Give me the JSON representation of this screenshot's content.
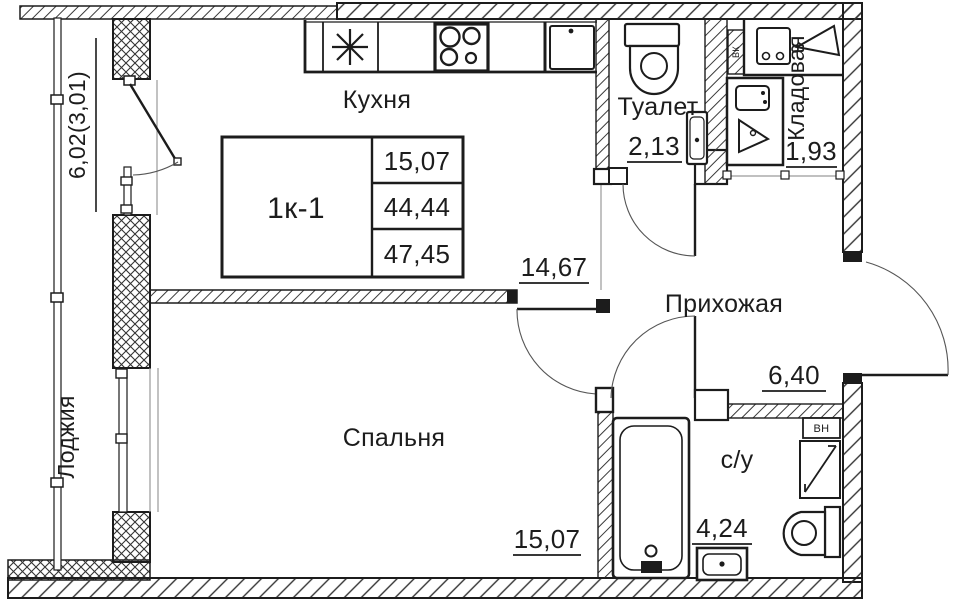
{
  "plan": {
    "rooms": {
      "kitchen": {
        "name": "Кухня",
        "area": "14,67"
      },
      "bedroom": {
        "name": "Спальня",
        "area": "15,07"
      },
      "hallway": {
        "name": "Прихожая",
        "area": "6,40"
      },
      "toilet": {
        "name": "Туалет",
        "area": "2,13"
      },
      "storage": {
        "name": "Кладовая",
        "area": "1,93"
      },
      "bathroom": {
        "name": "с/у",
        "area": "4,24"
      },
      "loggia": {
        "name": "Лоджия",
        "area": "6,02(3,01)"
      }
    },
    "info_table": {
      "unit": "1к-1",
      "living_area": "15,07",
      "apartment_area": "44,44",
      "total_area": "47,45"
    },
    "vent_shaft_label": "ВН",
    "vent_channel_label": "ВК",
    "colors": {
      "line": "#1c1c1c",
      "opening": "#8a8a8a",
      "background": "#ffffff"
    }
  }
}
